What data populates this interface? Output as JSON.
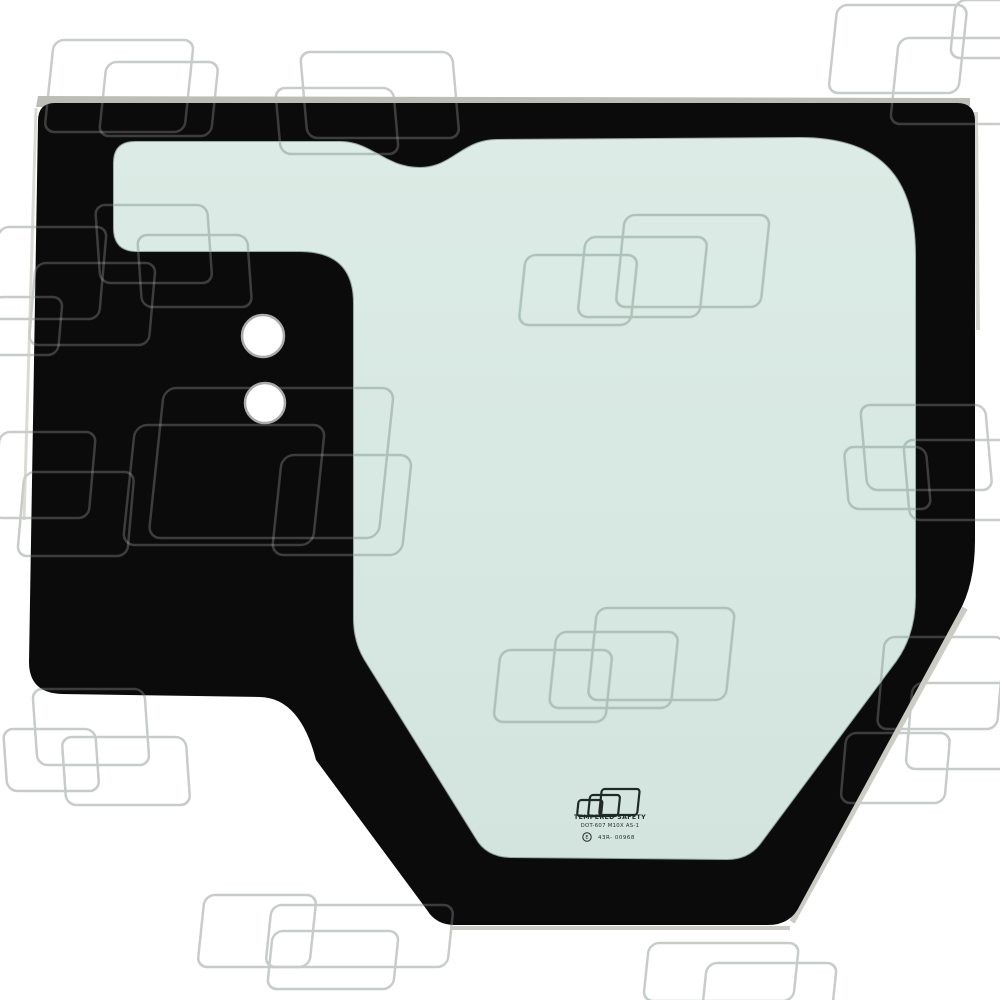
{
  "product": {
    "subject": "cab-glass-window-panel",
    "mounting_holes_count": "2"
  },
  "stamp": {
    "logo_icon": "overlapping-rectangles-logo",
    "line1": "TEMPERED SAFETY",
    "line2": "DOT-607 M10X AS-1",
    "e_mark_letter": "E",
    "line3": "43R- 00968"
  },
  "colors": {
    "background": "#ffffff",
    "frame_black": "#0b0b0b",
    "glass_green_light": "#dcebe5",
    "glass_green": "#d3e4de",
    "glass_edge_shadow": "rgba(20,35,28,0.32)",
    "edge_silver": "#bdbdb7",
    "edge_silver_light": "#ccccc6",
    "hole_rim": "#a8aba8",
    "watermark_on_white": "#c7ccc9",
    "watermark_on_black": "rgba(235,240,237,0.22)",
    "watermark_on_glass": "#a3b8b0",
    "stamp_ink": "#1f2a25"
  }
}
